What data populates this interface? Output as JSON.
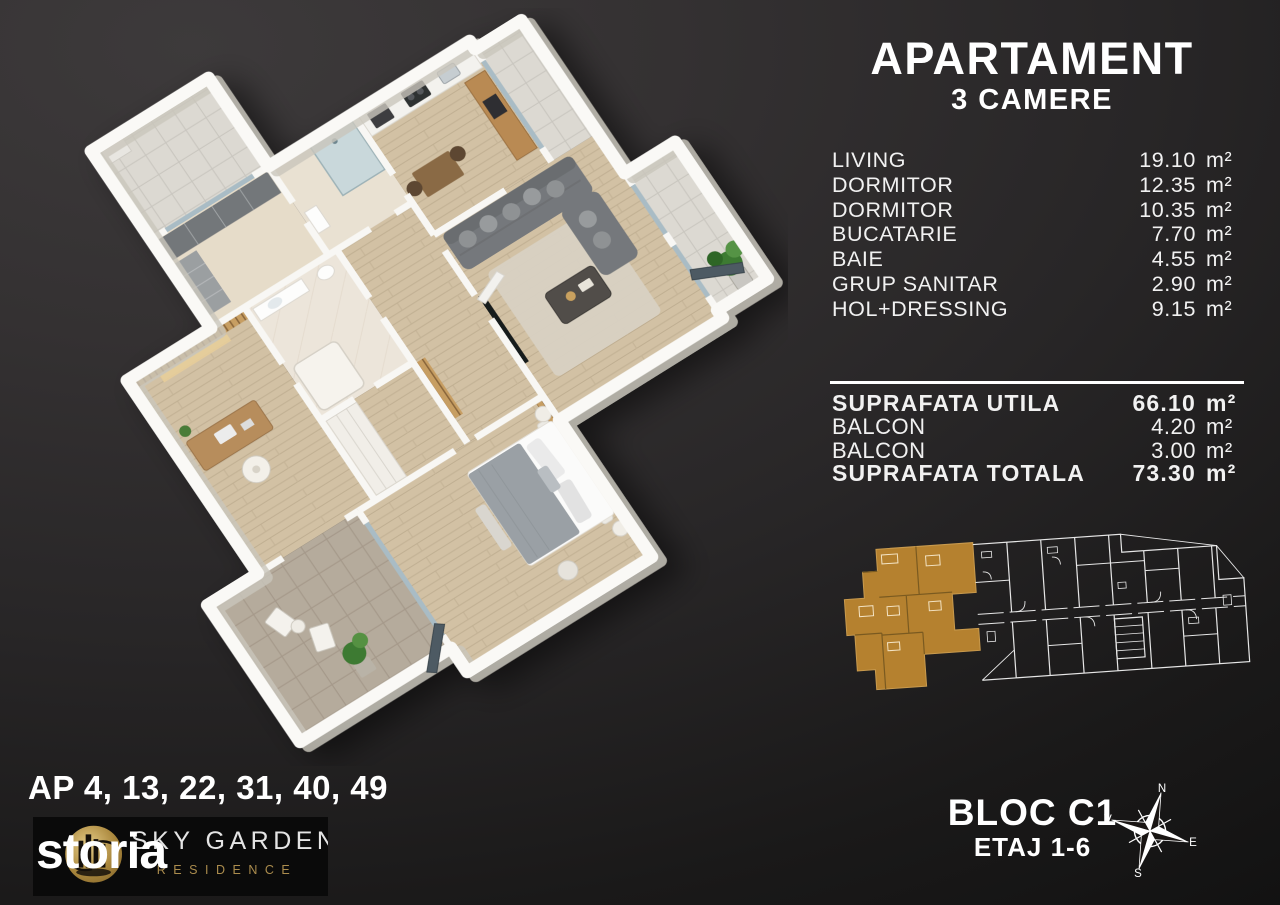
{
  "header": {
    "title": "APARTAMENT",
    "subtitle": "3 CAMERE"
  },
  "rooms": [
    {
      "label": "LIVING",
      "value": "19.10",
      "unit": "m²"
    },
    {
      "label": "DORMITOR",
      "value": "12.35",
      "unit": "m²"
    },
    {
      "label": "DORMITOR",
      "value": "10.35",
      "unit": "m²"
    },
    {
      "label": "BUCATARIE",
      "value": "7.70",
      "unit": "m²"
    },
    {
      "label": "BAIE",
      "value": "4.55",
      "unit": "m²"
    },
    {
      "label": "GRUP SANITAR",
      "value": "2.90",
      "unit": "m²"
    },
    {
      "label": "HOL+DRESSING",
      "value": "9.15",
      "unit": "m²"
    }
  ],
  "summary": [
    {
      "label": "SUPRAFATA UTILA",
      "value": "66.10",
      "unit": "m²"
    },
    {
      "label": "BALCON",
      "value": "4.20",
      "unit": "m²"
    },
    {
      "label": "BALCON",
      "value": "3.00",
      "unit": "m²"
    },
    {
      "label": "SUPRAFATA TOTALA",
      "value": "73.30",
      "unit": "m²"
    }
  ],
  "footer_left": {
    "apartments": "AP 4, 13, 22, 31, 40, 49",
    "watermark": "storia",
    "brand_line1": "SKY GARDEN",
    "brand_line2": "RESIDENCE"
  },
  "footer_right": {
    "bloc": "BLOC C1",
    "etaj": "ETAJ 1-6"
  },
  "compass": {
    "north": "N",
    "east": "E",
    "south": "S",
    "west": "V"
  },
  "colors": {
    "highlight_unit": "#b5812f",
    "plan_lines": "#e8e8e8",
    "logo_gold": "#ab8c4d",
    "background_top": "#3b3839",
    "background_bottom": "#101010",
    "text": "#ffffff"
  }
}
